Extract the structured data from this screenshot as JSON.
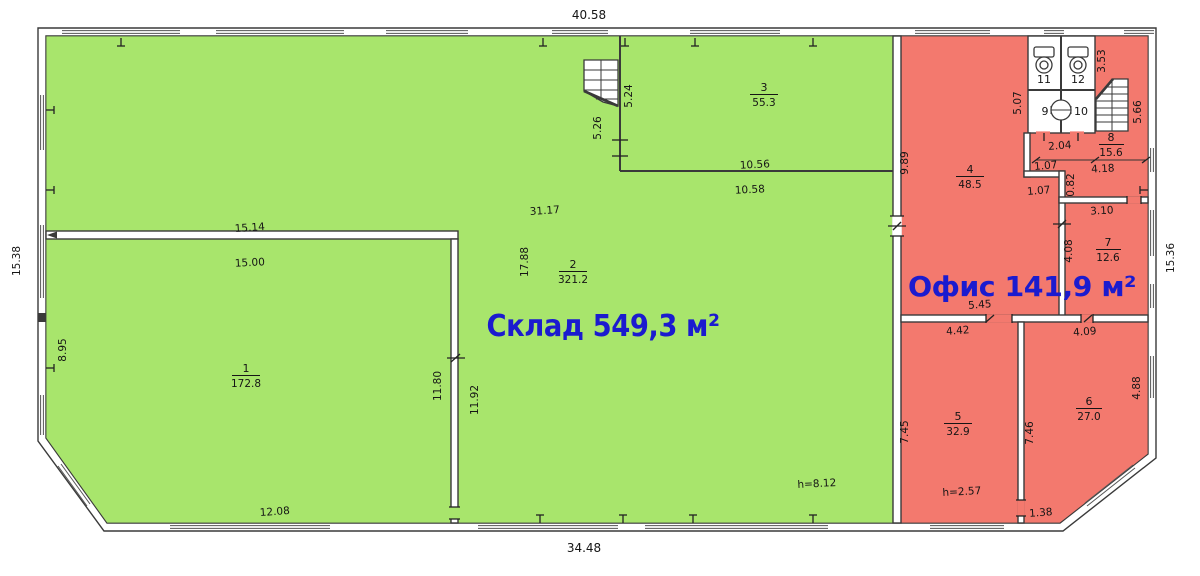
{
  "titles": {
    "warehouse": "Склад 549,3 м²",
    "office": "Офис 141,9 м²"
  },
  "rooms": {
    "r1": {
      "num": "1",
      "area": "172.8"
    },
    "r2": {
      "num": "2",
      "area": "321.2"
    },
    "r3": {
      "num": "3",
      "area": "55.3"
    },
    "r4": {
      "num": "4",
      "area": "48.5"
    },
    "r5": {
      "num": "5",
      "area": "32.9"
    },
    "r6": {
      "num": "6",
      "area": "27.0"
    },
    "r7": {
      "num": "7",
      "area": "12.6"
    },
    "r8": {
      "num": "8",
      "area": "15.6"
    },
    "r9": {
      "num": "9"
    },
    "r10": {
      "num": "10"
    },
    "r11": {
      "num": "11"
    },
    "r12": {
      "num": "12"
    }
  },
  "dims": {
    "top": "40.58",
    "bottom": "34.48",
    "bottom_left": "12.08",
    "left": "15.38",
    "left_inner": "8.95",
    "right": "15.36",
    "wall1_top": "15.14",
    "wall1_bot": "15.00",
    "r2_w": "31.17",
    "r2_h": "17.88",
    "wallb_l": "11.80",
    "wallb_r": "11.92",
    "r3_out_v": "5.26",
    "r3_in_v": "5.24",
    "r3_in_w": "10.56",
    "r3_out_w": "10.58",
    "h_sklad": "h=8.12",
    "r4_h": "9.89",
    "wc_h": "5.07",
    "r8_w": "3.53",
    "r8_h": "5.66",
    "wc_w": "2.04",
    "hall_w": "4.18",
    "step_a": "1.07",
    "step_b": "1.07",
    "step_v": "0.82",
    "r7_top": "3.10",
    "r7_h": "4.08",
    "r7_bot": "4.09",
    "hall2": "5.45",
    "r5_w": "4.42",
    "r5_h": "7.45",
    "r5_ceiling": "h=2.57",
    "r6_h": "7.46",
    "r6_side": "4.88",
    "r6_bot": "1.38"
  },
  "colors": {
    "warehouse_fill": "#a8e56c",
    "office_fill": "#f3796e",
    "wall_line": "#3a3a3a",
    "label_blue": "#1b1bcf"
  }
}
